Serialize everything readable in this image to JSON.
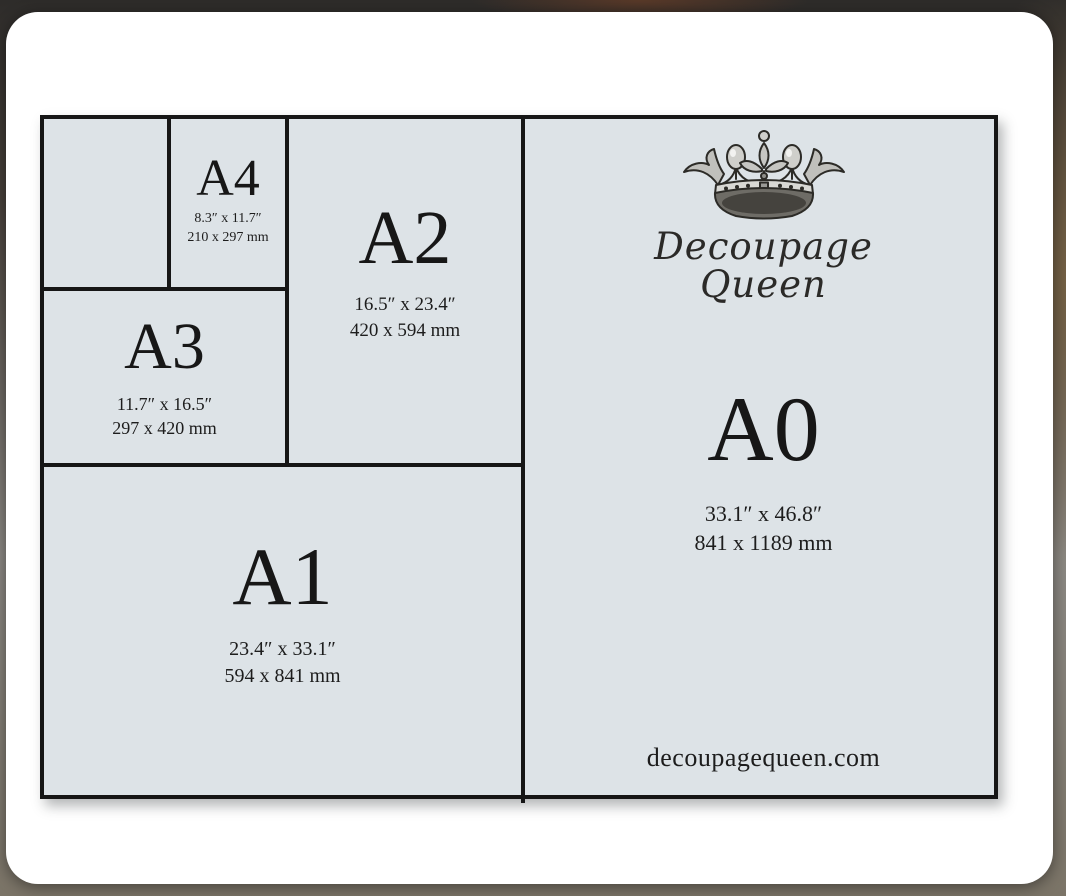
{
  "card": {
    "background": "#ffffff"
  },
  "diagram": {
    "background": "#dde3e7",
    "border_color": "#161616",
    "layout": "nested halving of A-series paper sizes; right half A0, lower-left A1, upper strip A2/A3/A4 with one unlabeled small cell"
  },
  "sizes": [
    {
      "code": "A0",
      "inches": "33.1″ x 46.8″",
      "mm": "841 x 1189 mm"
    },
    {
      "code": "A1",
      "inches": "23.4″ x 33.1″",
      "mm": "594 x 841 mm"
    },
    {
      "code": "A2",
      "inches": "16.5″ x 23.4″",
      "mm": "420 x 594 mm"
    },
    {
      "code": "A3",
      "inches": "11.7″ x 16.5″",
      "mm": "297 x 420 mm"
    },
    {
      "code": "A4",
      "inches": "8.3″ x 11.7″",
      "mm": "210 x 297 mm"
    }
  ],
  "brand": {
    "logo_icon": "crown-icon",
    "line1": "Decoupage",
    "line2": "Queen",
    "website": "decoupagequeen.com"
  },
  "colors": {
    "background_top": "#2e2c2a",
    "background_brown": "#6b503a",
    "background_bottom": "#7b7467",
    "text": "#1a1a1a"
  }
}
